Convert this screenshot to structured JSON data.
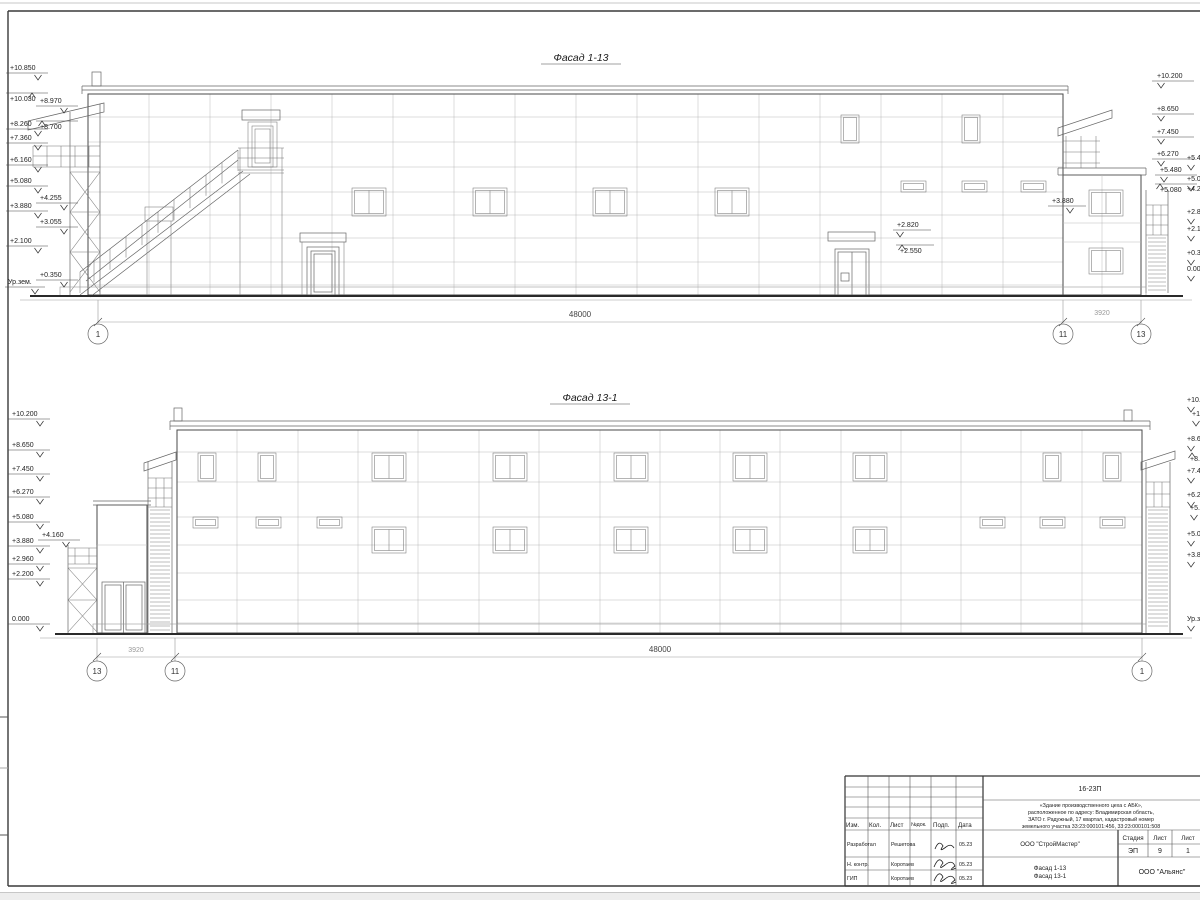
{
  "top_facade": {
    "title": "Фасад 1-13",
    "left_marks": [
      "+10.850",
      "+10.030",
      "+8.970",
      "+8.260",
      "+8.700",
      "+7.360",
      "+6.160",
      "+5.080",
      "+4.255",
      "+3.880",
      "+3.055",
      "+2.100",
      "+0.350",
      "Ур.зем."
    ],
    "right_marks": [
      "+10.200",
      "+8.650",
      "+7.450",
      "+6.270",
      "+5.480",
      "+5.080"
    ],
    "edge_marks": [
      "+5.480",
      "+5.080",
      "+4.255",
      "+2.820",
      "+2.100",
      "+0.350",
      "0.000"
    ],
    "inner_marks": {
      "m3880": "+3.880",
      "m2820": "+2.820",
      "m2550": "+2.550"
    },
    "dim_main": "48000",
    "dim_side": "3920",
    "axes": {
      "a1": "1",
      "a11": "11",
      "a13": "13"
    }
  },
  "bottom_facade": {
    "title": "Фасад 13-1",
    "left_marks": [
      "+10.200",
      "+8.650",
      "+7.450",
      "+6.270",
      "+5.080",
      "+3.880",
      "+4.160",
      "+2.960",
      "+2.200",
      "0.000"
    ],
    "edge_marks": [
      "+10.200",
      "+10.030",
      "+8.650",
      "+8.450",
      "+7.450",
      "+6.270",
      "+5.480",
      "+5.080",
      "+3.880",
      "Ур.зем."
    ],
    "dim_main": "48000",
    "dim_side": "3920",
    "axes": {
      "a13": "13",
      "a11": "11",
      "a1": "1"
    }
  },
  "title_block": {
    "doc_number": "16-23П",
    "description_lines": [
      "«Здание производственного цеха с АБК»,",
      "расположенное по адресу: Владимирская область,",
      "ЗАТО г. Радужный, 17 квартал, кадастровый номер",
      "земельного участка 33:23:000101:456, 33:23:000101:508"
    ],
    "columns": [
      "Изм.",
      "Кол.",
      "Лист",
      "№док.",
      "Подп.",
      "Дата"
    ],
    "rows": [
      {
        "role": "Разработал",
        "name": "Решетова",
        "date": "05.23"
      },
      {
        "role": "Н. контр.",
        "name": "Коротаев",
        "date": "05.23"
      },
      {
        "role": "ГИП",
        "name": "Коротаев",
        "date": "05.23"
      }
    ],
    "company": "ООО \"СтройМастер\"",
    "stage_label": "Стадия",
    "sheet_label": "Лист",
    "sheets_label": "Лист",
    "stage": "ЭП",
    "sheet": "9",
    "sheets": "1",
    "sheet_title_lines": [
      "Фасад 1-13",
      "Фасад 13-1"
    ],
    "contractor": "ООО \"Альянс\""
  }
}
